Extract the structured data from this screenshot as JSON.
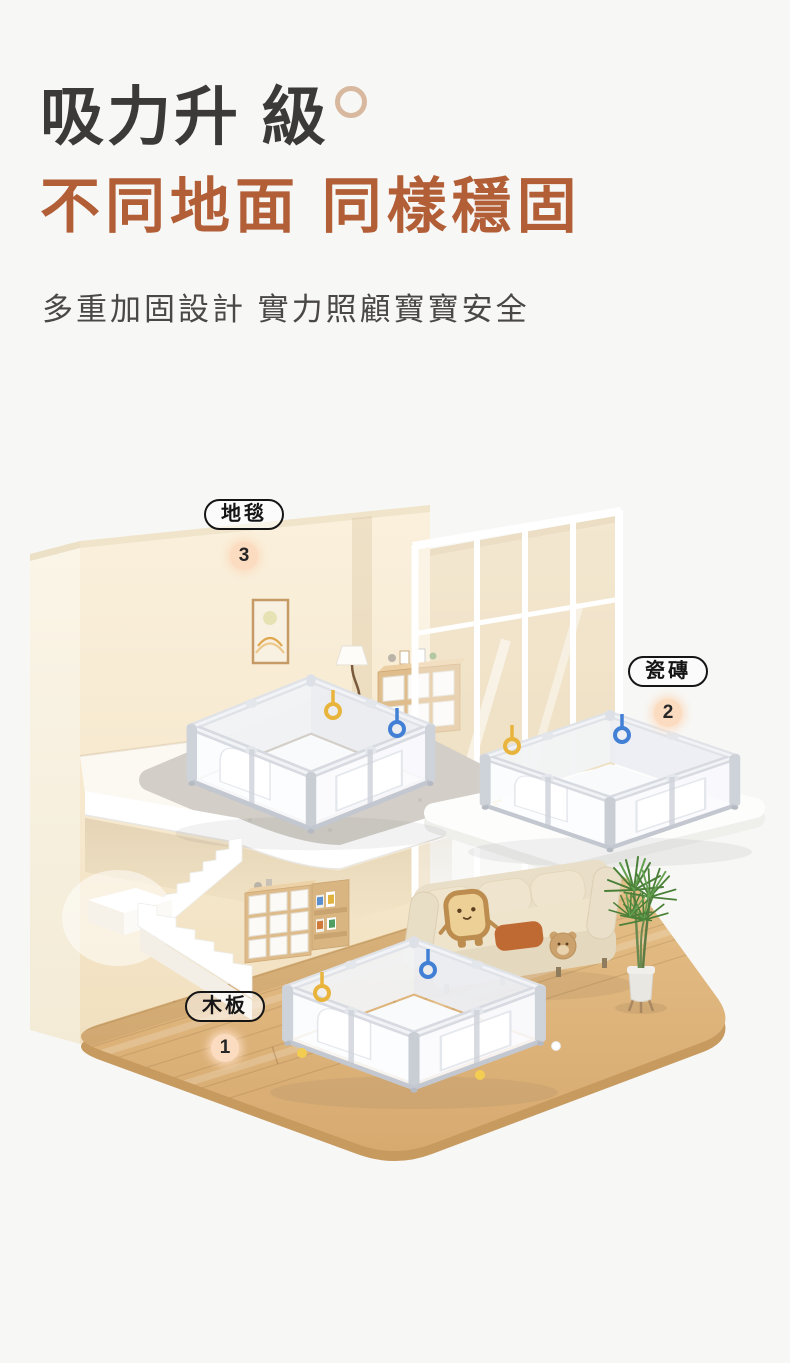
{
  "heading": {
    "title": "吸力升 級",
    "subtitle": "不同地面 同樣穩固",
    "description": "多重加固設計  實力照顧寶寶安全",
    "title_color": "#3c3a38",
    "subtitle_color": "#b25f38"
  },
  "scene": {
    "labels": [
      {
        "id": "carpet",
        "text": "地毯",
        "number": "3"
      },
      {
        "id": "tile",
        "text": "瓷磚",
        "number": "2"
      },
      {
        "id": "wood",
        "text": "木板",
        "number": "1"
      }
    ],
    "badge_color": "#fcdcc0",
    "label_border_color": "#151515",
    "colors": {
      "wall_cream": "#f8ecd6",
      "wall_tan": "#ecd9b6",
      "wood_floor": "#deb47c",
      "carpet_gray": "#d3cfc8",
      "slab_white": "#fdfdfc",
      "playpen_frame": "#d7dae0",
      "sofa_beige": "#e8ddc5",
      "pillow_orange": "#c06a33",
      "plant_green": "#4a8038",
      "pull_ring_yellow": "#e9b43c",
      "pull_ring_blue": "#4280d6"
    }
  }
}
